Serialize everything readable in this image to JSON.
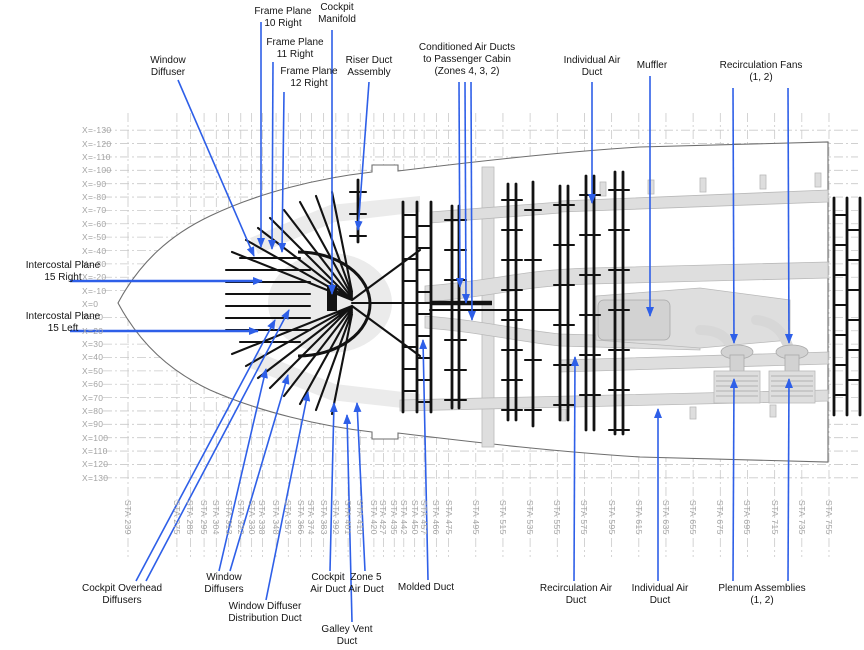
{
  "colors": {
    "arrow_blue": "#2e5fe8",
    "duct_black": "#121212",
    "structure_gray": "#dedede",
    "grid_gray": "#c9c9c9",
    "axis_text": "#a3a3a3",
    "label_text": "#141414"
  },
  "callouts": {
    "top": [
      {
        "id": "frame-plane-10-right",
        "label": "Frame Plane\n10 Right"
      },
      {
        "id": "cockpit-manifold",
        "label": "Cockpit\nManifold"
      },
      {
        "id": "frame-plane-11-right",
        "label": "Frame Plane\n11 Right"
      },
      {
        "id": "window-diffuser",
        "label": "Window\nDiffuser"
      },
      {
        "id": "frame-plane-12-right",
        "label": "Frame Plane\n12 Right"
      },
      {
        "id": "riser-duct-assembly",
        "label": "Riser Duct\nAssembly"
      },
      {
        "id": "conditioned-air-ducts",
        "label": "Conditioned Air Ducts\nto Passenger Cabin\n(Zones 4, 3, 2)"
      },
      {
        "id": "individual-air-duct-top",
        "label": "Individual Air\nDuct"
      },
      {
        "id": "muffler",
        "label": "Muffler"
      },
      {
        "id": "recirculation-fans",
        "label": "Recirculation Fans\n(1, 2)"
      }
    ],
    "left": [
      {
        "id": "intercostal-plane-15-right",
        "label": "Intercostal Plane\n15 Right"
      },
      {
        "id": "intercostal-plane-15-left",
        "label": "Intercostal Plane\n15 Left"
      }
    ],
    "bottom": [
      {
        "id": "cockpit-overhead-diffusers",
        "label": "Cockpit Overhead\nDiffusers"
      },
      {
        "id": "window-diffusers",
        "label": "Window\nDiffusers"
      },
      {
        "id": "window-diffuser-distribution-duct",
        "label": "Window Diffuser\nDistribution Duct"
      },
      {
        "id": "cockpit-air-duct",
        "label": "Cockpit\nAir Duct"
      },
      {
        "id": "zone-5-air-duct",
        "label": "Zone 5\nAir Duct"
      },
      {
        "id": "galley-vent-duct",
        "label": "Galley Vent\nDuct"
      },
      {
        "id": "molded-duct",
        "label": "Molded Duct"
      },
      {
        "id": "recirculation-air-duct",
        "label": "Recirculation Air\nDuct"
      },
      {
        "id": "individual-air-duct-bottom",
        "label": "Individual Air\nDuct"
      },
      {
        "id": "plenum-assemblies",
        "label": "Plenum Assemblies\n(1, 2)"
      }
    ]
  },
  "axes": {
    "x_labels": [
      "X=-130",
      "X=-120",
      "X=-110",
      "X=-100",
      "X=-90",
      "X=-80",
      "X=-70",
      "X=-60",
      "X=-50",
      "X=-40",
      "X=-30",
      "X=-20",
      "X=-10",
      "X=0",
      "X=10",
      "X=20",
      "X=30",
      "X=40",
      "X=50",
      "X=60",
      "X=70",
      "X=80",
      "X=90",
      "X=100",
      "X=110",
      "X=120",
      "X=130"
    ],
    "sta_labels": [
      "STA 239",
      "STA 275",
      "STA 285",
      "STA 295",
      "STA 304",
      "STA 313",
      "STA 322",
      "STA 330",
      "STA 338",
      "STA 348",
      "STA 357",
      "STA 366",
      "STA 374",
      "STA 383",
      "STA 392",
      "STA 401",
      "STA 410",
      "STA 420",
      "STA 427",
      "STA 435",
      "STA 442",
      "STA 450",
      "STA 457",
      "STA 466",
      "STA 475",
      "STA 495",
      "STA 515",
      "STA 535",
      "STA 555",
      "STA 575",
      "STA 595",
      "STA 615",
      "STA 635",
      "STA 655",
      "STA 675",
      "STA 695",
      "STA 715",
      "STA 735",
      "STA 755"
    ]
  }
}
